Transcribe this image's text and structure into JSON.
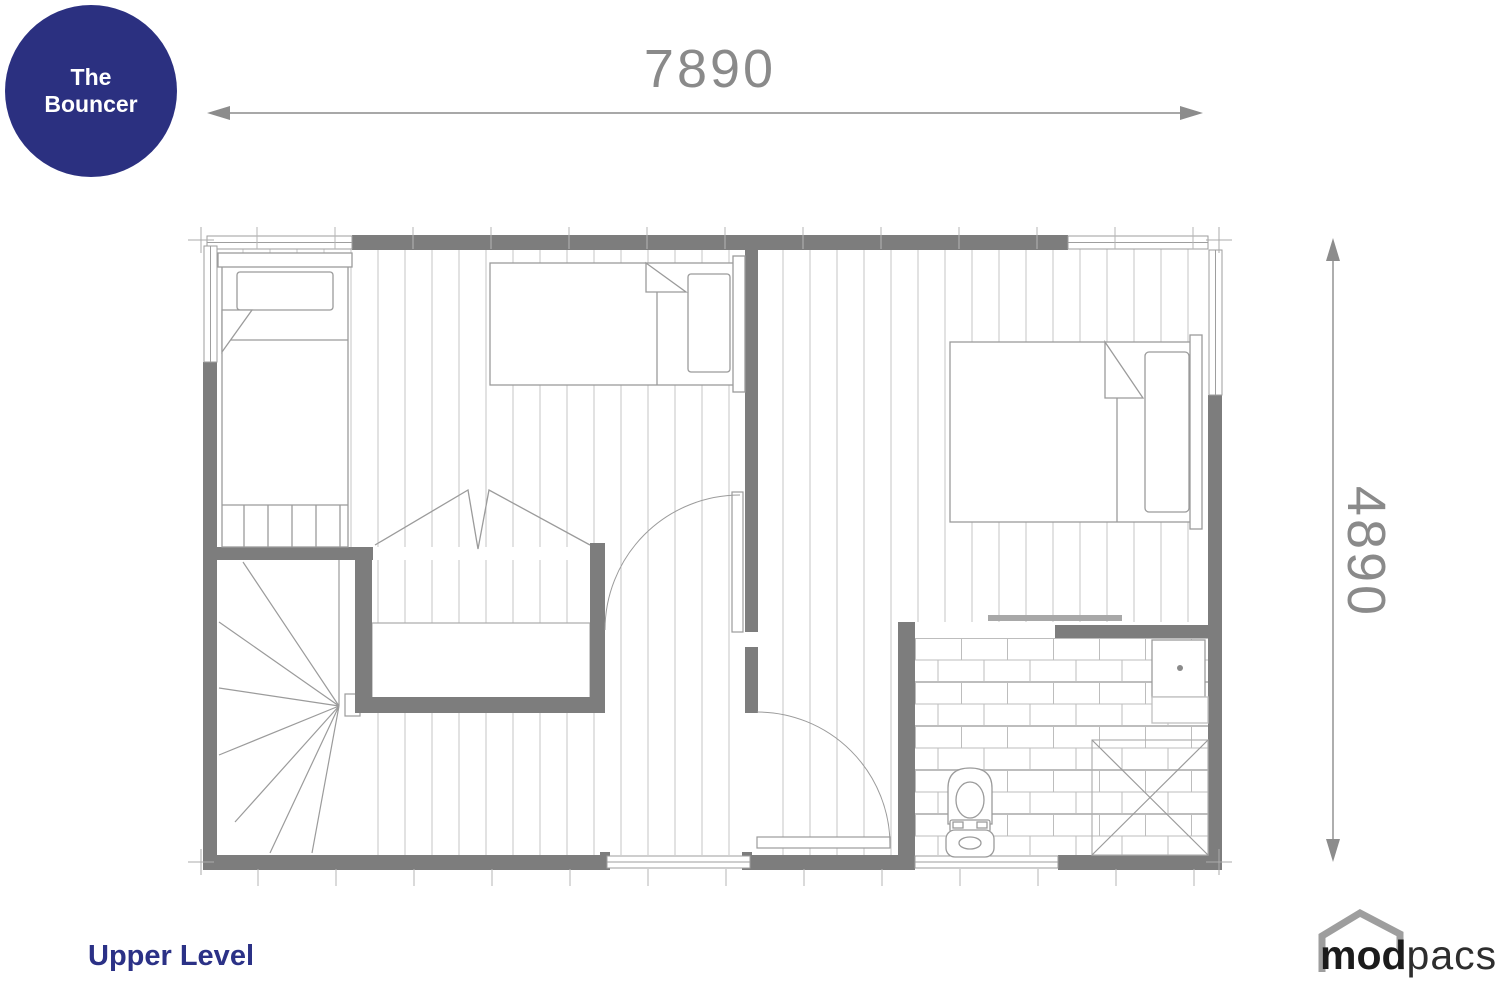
{
  "badge": {
    "line1": "The",
    "line2": "Bouncer"
  },
  "dimensions": {
    "width_label": "7890",
    "height_label": "4890"
  },
  "floor_label": "Upper Level",
  "logo": {
    "bold": "mod",
    "regular": "pacs"
  },
  "colors": {
    "badge_bg": "#2b3080",
    "badge_text": "#ffffff",
    "floor_label_color": "#2b3186",
    "dimension_color": "#8a8a8a",
    "wall_color": "#7d7d7d",
    "plan_line_color": "#9b9b9b",
    "logo_house_color": "#9e9e9e"
  }
}
